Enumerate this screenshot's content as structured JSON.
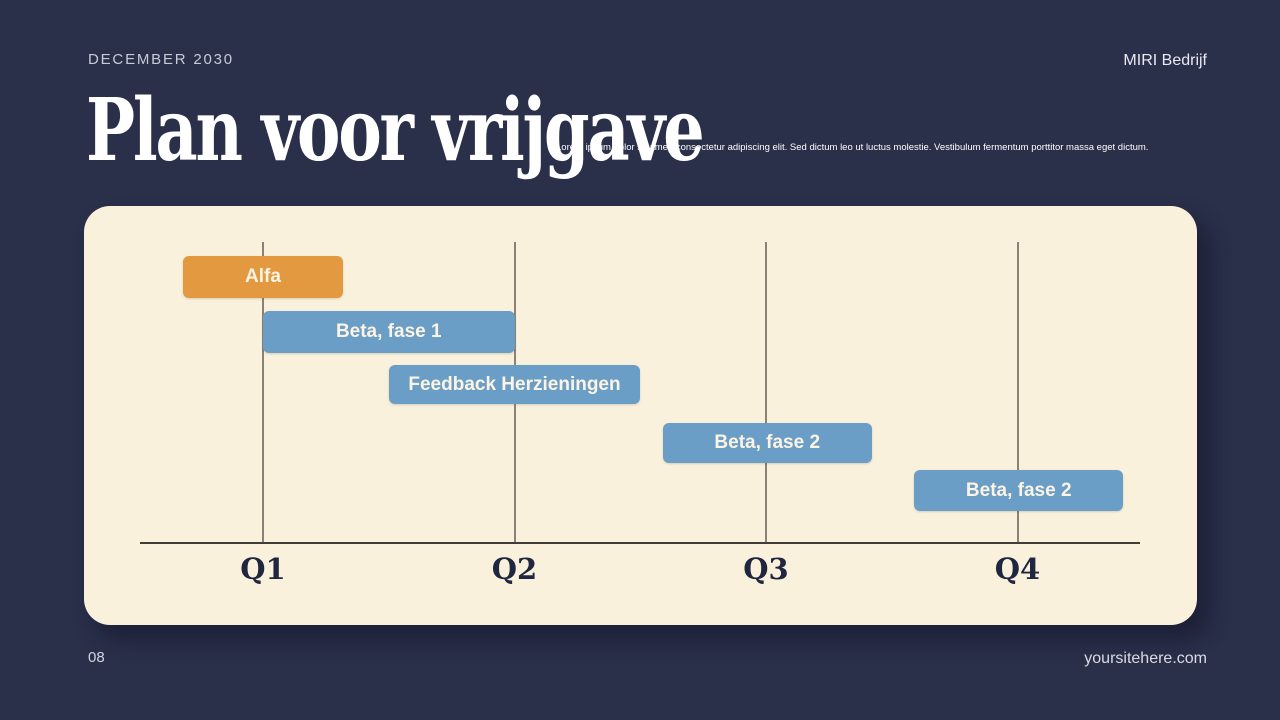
{
  "header": {
    "date": "DECEMBER 2030",
    "company": "MIRI Bedrijf"
  },
  "title": "Plan voor vrijgave",
  "description": "Lorem ipsum dolor sit amet, consectetur adipiscing elit. Sed dictum leo ut luctus molestie. Vestibulum fermentum porttitor massa eget dictum.",
  "footer": {
    "page_number": "08",
    "website": "yoursitehere.com"
  },
  "colors": {
    "background": "#2a2f4a",
    "panel": "#faf1dd",
    "accent_orange": "#e2993f",
    "accent_blue": "#6b9ec6",
    "gridline": "#8a8274",
    "axis": "#403d36",
    "axis_label": "#20263f",
    "bar_text": "#fbf4e4"
  },
  "chart_data": {
    "type": "bar",
    "variant": "gantt-timeline",
    "title": "Plan voor vrijgave",
    "categories": [
      "Q1",
      "Q2",
      "Q3",
      "Q4"
    ],
    "x_unit": "quarter",
    "xlim": [
      0.5,
      4.9
    ],
    "grid": "vertical-lines-at-quarters",
    "legend": null,
    "tasks": [
      {
        "label": "Alfa",
        "row": 1,
        "start": 0.68,
        "end": 1.32,
        "color_key": "accent_orange"
      },
      {
        "label": "Beta, fase 1",
        "row": 2,
        "start": 1.0,
        "end": 2.0,
        "color_key": "accent_blue"
      },
      {
        "label": "Feedback Herzieningen",
        "row": 3,
        "start": 1.5,
        "end": 2.5,
        "color_key": "accent_blue"
      },
      {
        "label": "Beta, fase 2",
        "row": 4,
        "start": 2.59,
        "end": 3.42,
        "color_key": "accent_blue"
      },
      {
        "label": "Beta, fase 2",
        "row": 5,
        "start": 3.59,
        "end": 4.42,
        "color_key": "accent_blue"
      }
    ]
  }
}
